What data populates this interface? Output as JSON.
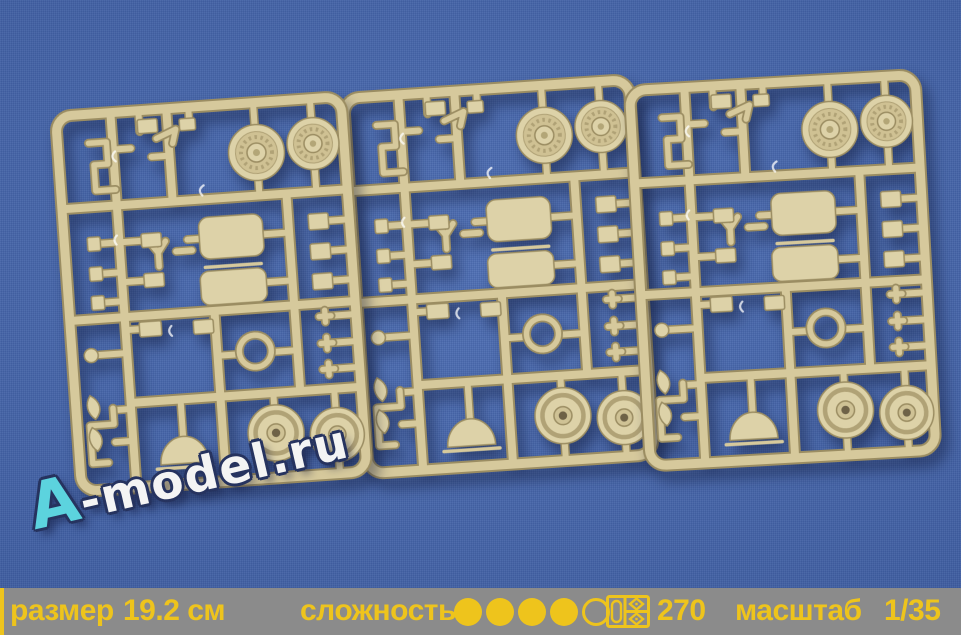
{
  "watermark": {
    "prefix": "A",
    "rest": "-model.ru"
  },
  "info_bar": {
    "size_label": "размер",
    "size_value": "19.2 см",
    "complexity_label": "сложность",
    "complexity": {
      "filled": 4,
      "total": 5
    },
    "sprue_icon": "sprue-icon",
    "parts_count": "270",
    "scale_label": "масштаб",
    "scale_value": "1/35"
  },
  "colors": {
    "background": "#4164ae",
    "bar_bg": "#8b8b8b",
    "accent_yellow": "#eec41c",
    "sprue_plastic": "#d6c99c",
    "watermark_a": "#5cd3de",
    "watermark_text": "#f4f4f4"
  },
  "scene": {
    "sprue_count": 3
  }
}
